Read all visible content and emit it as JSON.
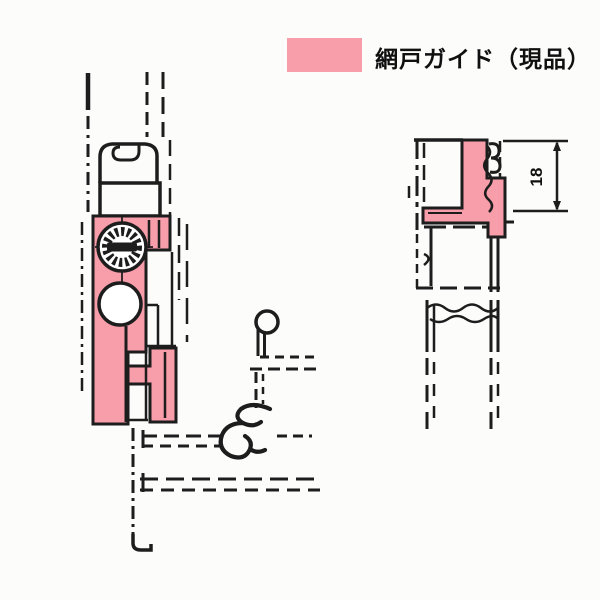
{
  "colors": {
    "pink": "#f89daa",
    "ink": "#1d1d1d",
    "paper": "#fcfcfb"
  },
  "legend": {
    "label": "網戸ガイド（現品）",
    "swatch_meaning": "screen-door-guide-highlight"
  },
  "dimension": {
    "value": "18"
  }
}
